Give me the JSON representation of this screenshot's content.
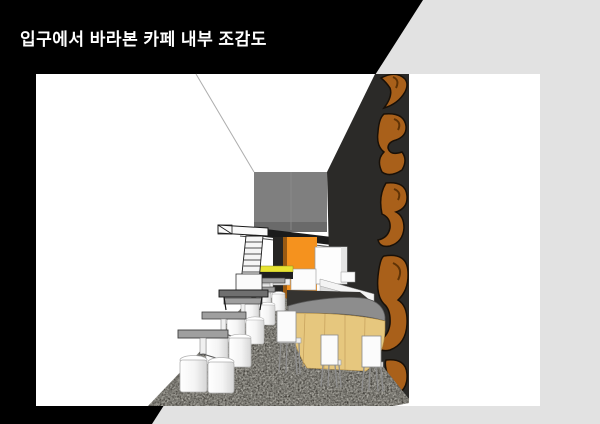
{
  "title": {
    "text": "입구에서 바라본 카페 내부 조감도"
  },
  "colors": {
    "background": "#000000",
    "diagonal_band": "#e2e2e2",
    "render_canvas": "#ffffff",
    "title_text": "#ffffff",
    "back_wall": "#7f7f7f",
    "right_wall": "#2b2a28",
    "signage_orange": "#a9601a",
    "accent_wall_orange": "#f5921e",
    "counter_wood": "#e6c77e",
    "counter_top": "#8d8d8d",
    "floor": "#413f39",
    "bench_yellow": "#e8e432"
  }
}
